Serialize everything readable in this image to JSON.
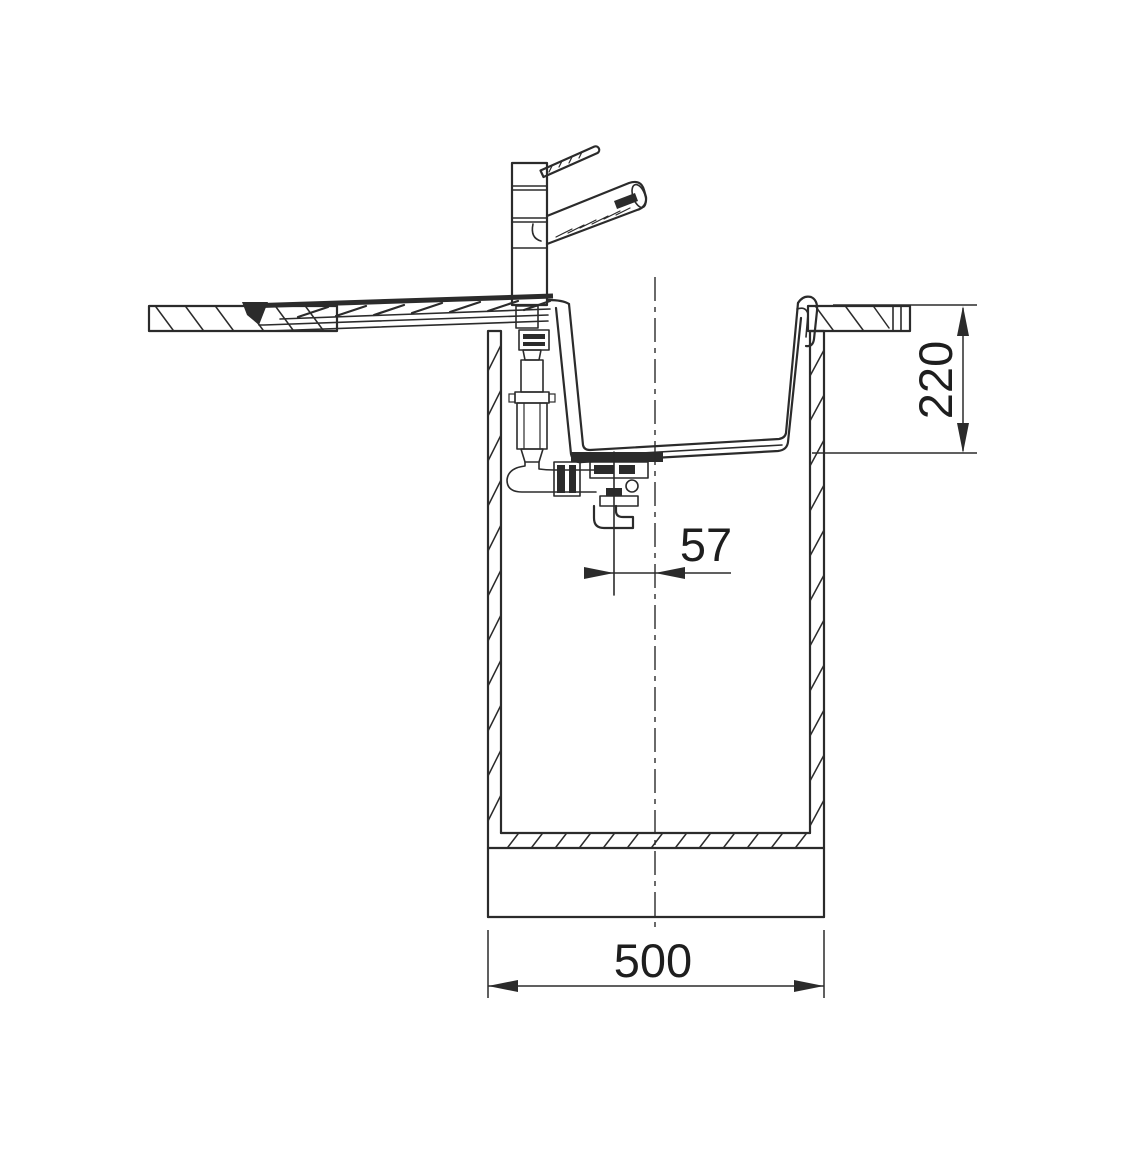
{
  "drawing": {
    "background": "#ffffff",
    "line_color": "#2b2b2b",
    "dimensions": {
      "bowl_depth": {
        "label": "220"
      },
      "drain_offset": {
        "label": "57"
      },
      "cabinet_width": {
        "label": "500"
      }
    }
  }
}
